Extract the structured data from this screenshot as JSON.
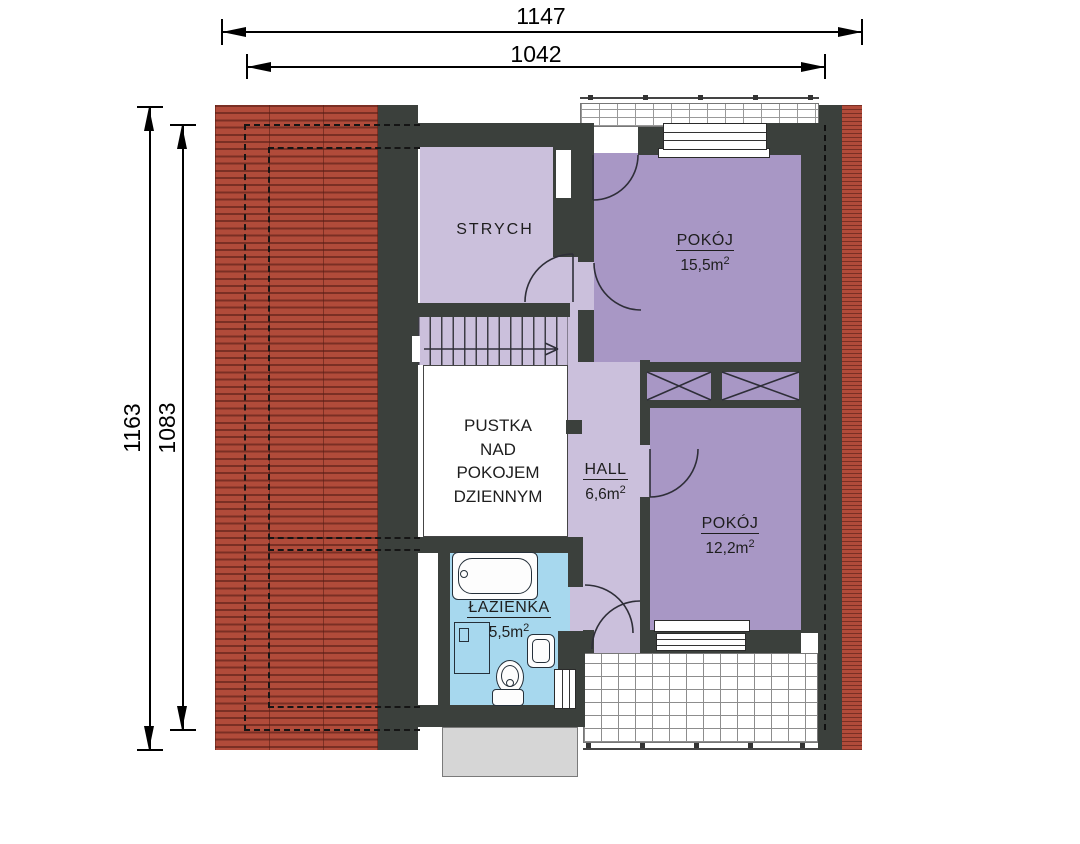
{
  "dimensions": {
    "top_outer": "1147",
    "top_inner": "1042",
    "left_outer": "1163",
    "left_inner": "1083"
  },
  "rooms": {
    "strych": {
      "name": "STRYCH"
    },
    "pokoj_155": {
      "name": "POKÓJ",
      "area": "15,5m",
      "area_sup": "2"
    },
    "hall": {
      "name": "HALL",
      "area": "6,6m",
      "area_sup": "2"
    },
    "pokoj_122": {
      "name": "POKÓJ",
      "area": "12,2m",
      "area_sup": "2"
    },
    "lazienka": {
      "name": "ŁAZIENKA",
      "area": "5,5m",
      "area_sup": "2"
    },
    "pustka": {
      "line1": "PUSTKA",
      "line2": "NAD",
      "line3": "POKOJEM",
      "line4": "DZIENNYM"
    }
  },
  "colors": {
    "roof_red": "#b14b3a",
    "roof_stripe": "#7a2f24",
    "wall_dark": "#3b403c",
    "room_purple": "#a897c5",
    "room_light_purple": "#cbc0dc",
    "bathroom_blue": "#a7d8ee",
    "void_white": "#ffffff",
    "chimney_gray": "#d6d6d6"
  }
}
